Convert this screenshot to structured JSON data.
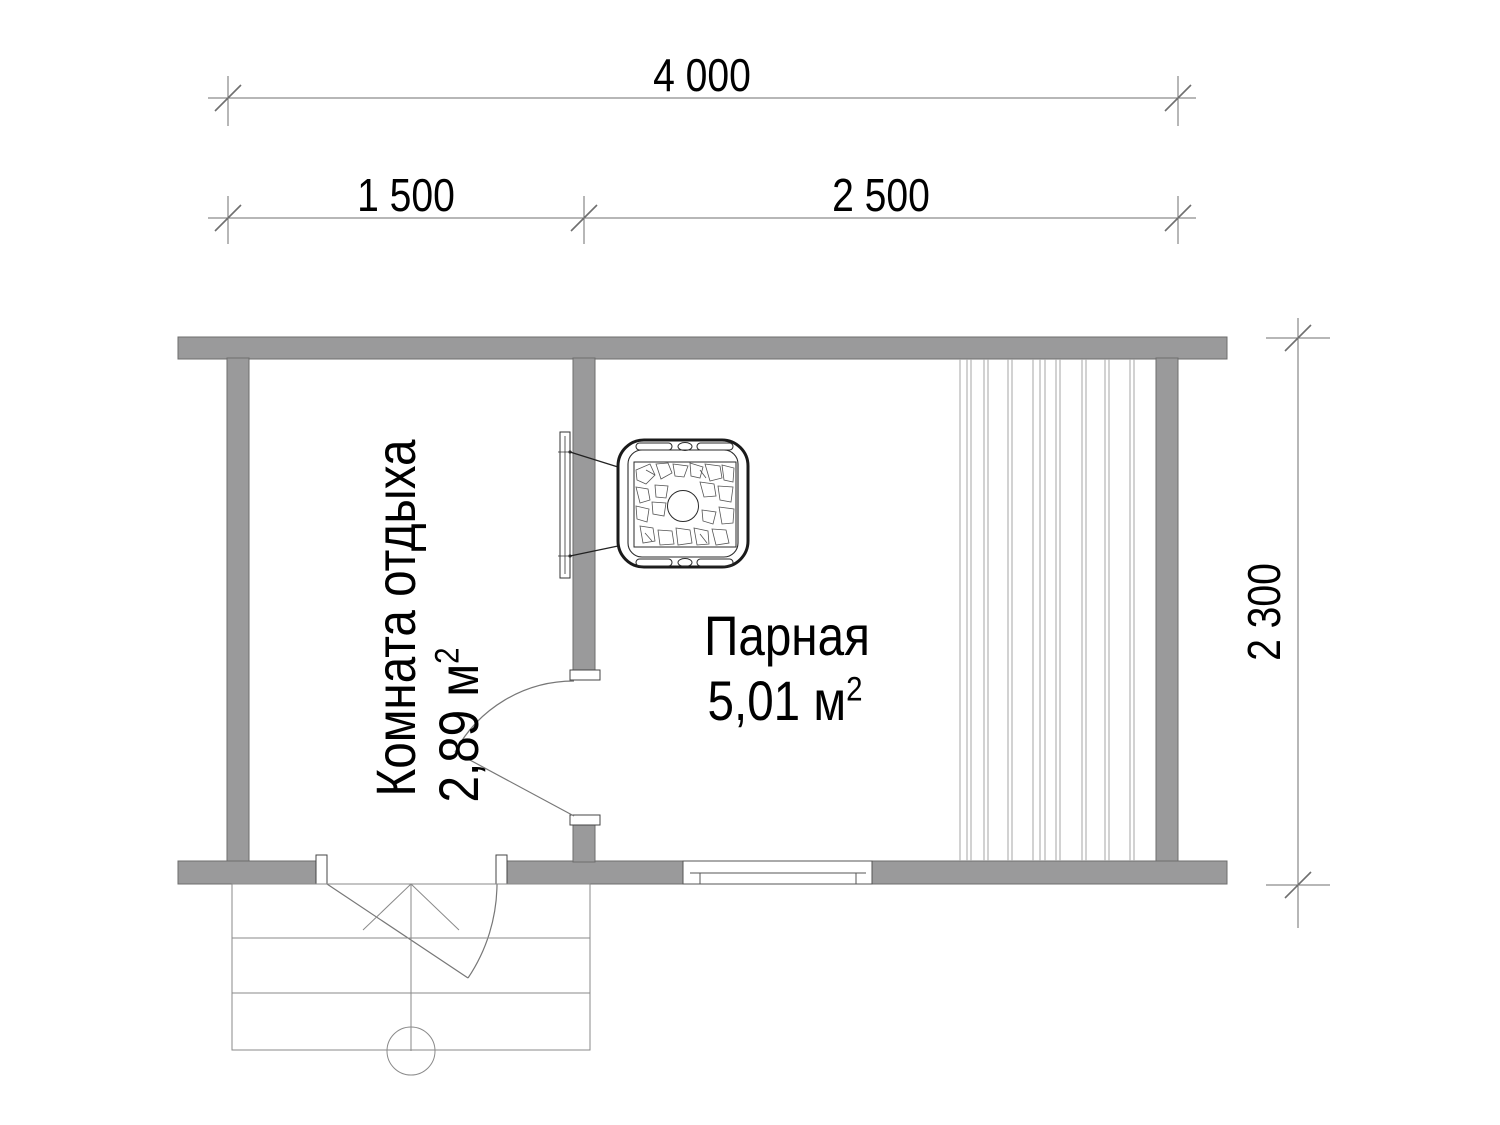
{
  "plan": {
    "dim_total": "4 000",
    "dim_left": "1 500",
    "dim_right": "2 500",
    "dim_depth": "2 300",
    "room_rest": {
      "name": "Комната отдыха",
      "area_value": "2,89 м",
      "area_sup": "2"
    },
    "room_steam": {
      "name": "Парная",
      "area_value": "5,01 м",
      "area_sup": "2"
    }
  },
  "colors": {
    "wall_fill": "#9a9a9b",
    "wall_stroke": "#6d6d6d",
    "thin_line": "#8a8a8a",
    "dim_line": "#6f6f6f",
    "text": "#000000"
  }
}
